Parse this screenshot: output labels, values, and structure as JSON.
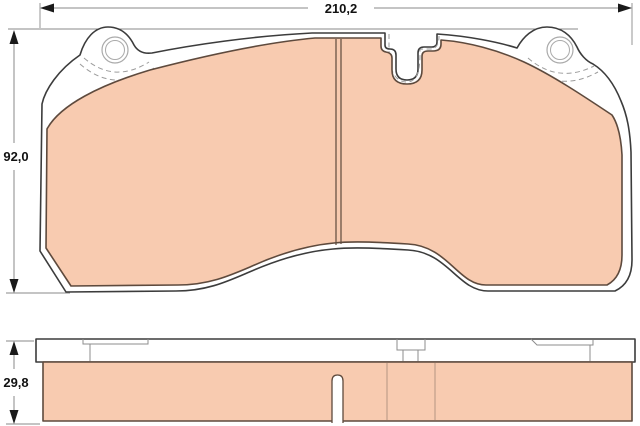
{
  "dimensions": {
    "width_label": "210,2",
    "height_label": "92,0",
    "thickness_label": "29,8"
  },
  "colors": {
    "background": "#ffffff",
    "friction_fill": "#f8cbb0",
    "friction_stroke": "#5e4a3d",
    "plate_stroke": "#3c3c3c",
    "dim_line": "#8a8a8a",
    "hidden_line": "#9c9c9c",
    "hole_stroke": "#aaaaaa",
    "detail_line": "#8d8d8d",
    "text_color": "#111111"
  }
}
